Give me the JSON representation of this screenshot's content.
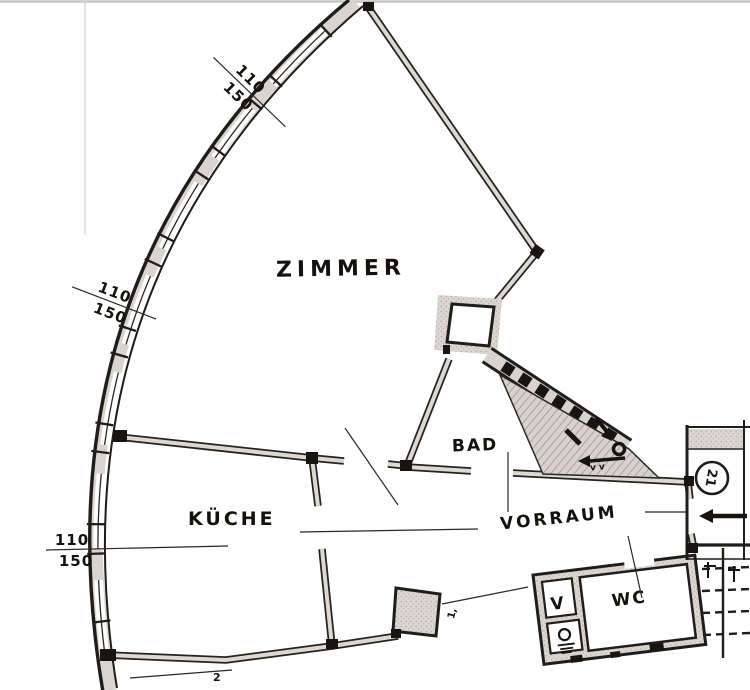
{
  "drawing": {
    "type": "apartment-floor-plan-scan",
    "rooms": {
      "zimmer": "ZIMMER",
      "kueche": "KÜCHE",
      "bad": "BAD",
      "vorraum": "VORRAUM",
      "wc": "WC"
    },
    "shaft_labels": {
      "vent": "V",
      "vent_small": "v v"
    },
    "window_dimensions": [
      {
        "top": "110",
        "bottom": "150"
      },
      {
        "top": "110",
        "bottom": "150"
      },
      {
        "top": "110",
        "bottom": "150"
      }
    ],
    "annotations": {
      "stair_marker": "21",
      "pier_note": "1,",
      "bottom_note": "2"
    },
    "colors": {
      "paper": "#ffffff",
      "ink": "#1f1d1a",
      "wall_fill": "#d9d5ce",
      "frame_line": "#c9c9c9"
    }
  }
}
